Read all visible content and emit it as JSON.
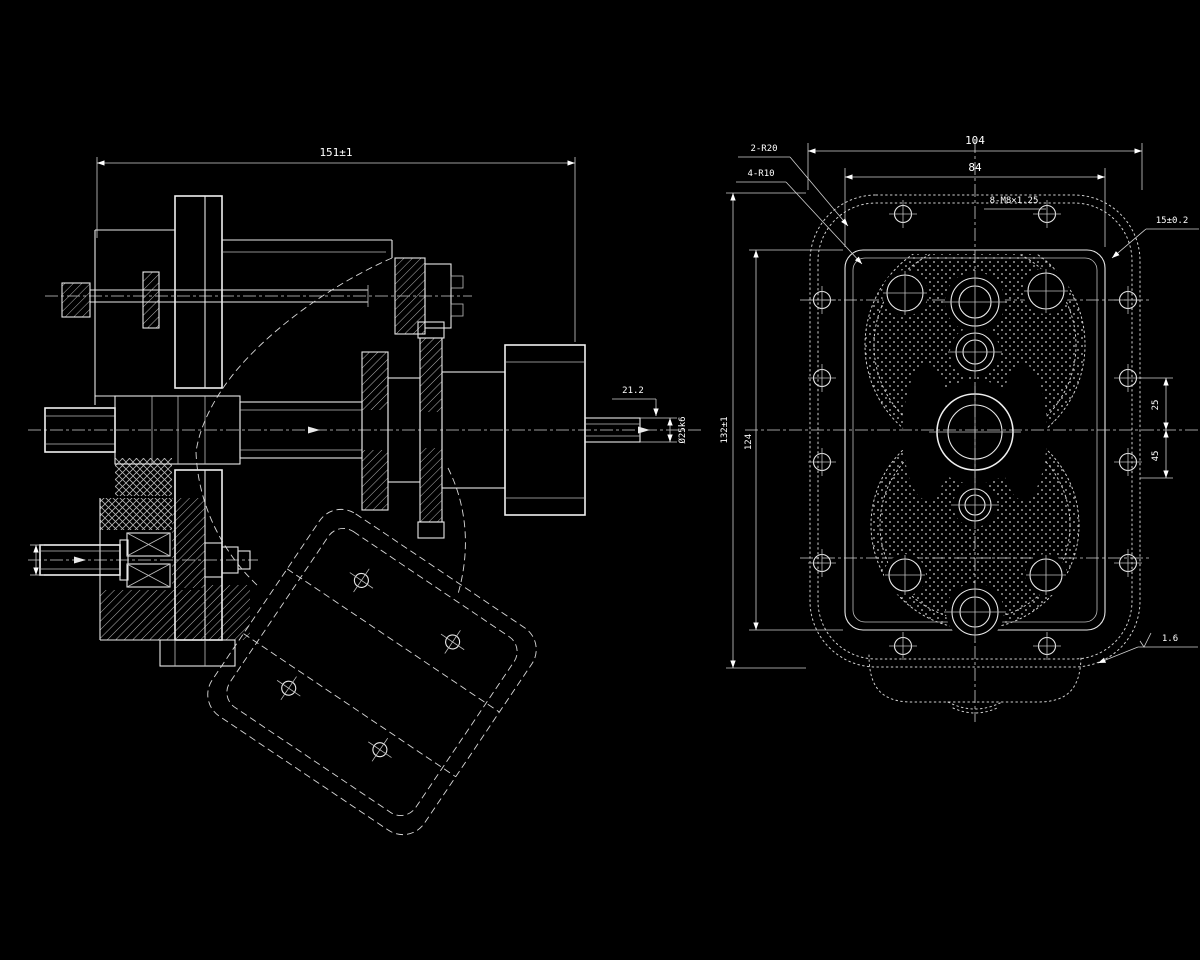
{
  "drawing": {
    "type": "technical-cad-drawing",
    "background_color": "#000000",
    "line_color": "#e8e8e8",
    "text_color": "#ffffff",
    "views": [
      "side-section-view",
      "front-face-view"
    ]
  },
  "left_view": {
    "overall_length": "151±1",
    "keyway_dim": "21.2",
    "shaft_dia": "Ø25k6"
  },
  "right_view": {
    "overall_width": "104",
    "bolt_span_width": "84",
    "overall_height": "132±1",
    "bolt_span_height": "124",
    "corner_radius": "2-R20",
    "fillet_radius": "4-R10",
    "upper_offset": "25",
    "lower_offset": "45",
    "corner_thickness": "15±0.2",
    "thread_callout": "8-M8×1.25",
    "surface_finish": "1.6"
  }
}
